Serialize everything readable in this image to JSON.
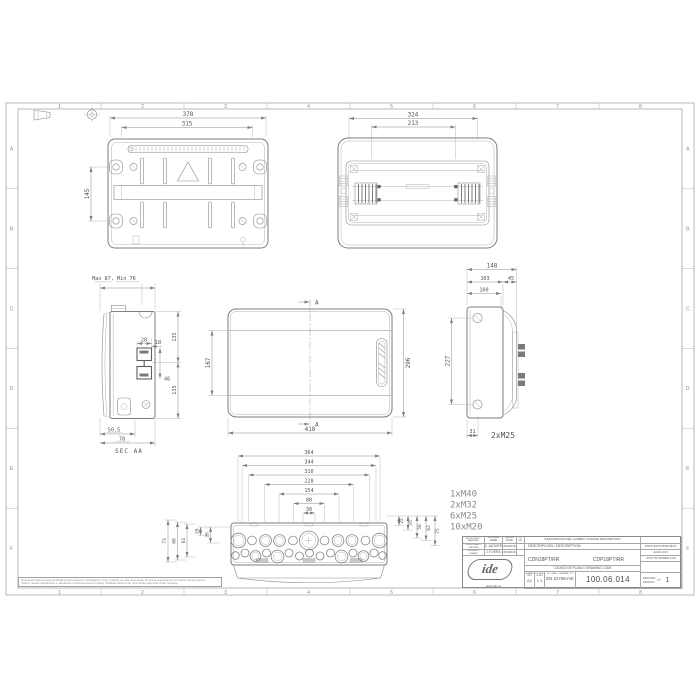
{
  "sheet": {
    "columns": [
      "1",
      "2",
      "3",
      "4",
      "5",
      "6",
      "7",
      "8"
    ],
    "rows": [
      "A",
      "B",
      "C",
      "D",
      "E",
      "F"
    ],
    "disclaimer_1": "Queda terminantemente prohibida la reproducción o divulgación, total o parcial, de este documento sin previa autorización por escrito de la empresa.",
    "disclaimer_2": "Total or partial reproduction or disclosure of this document is strictly forbidden without the prior written approval of the company."
  },
  "views": {
    "back": {
      "dim_378": "378",
      "dim_315": "315",
      "dim_145": "145"
    },
    "front_open": {
      "dim_324": "324",
      "dim_213": "213"
    },
    "section": {
      "max_min": "Max 87, Min 76",
      "dim_135_top": "135",
      "dim_28": "28",
      "dim_18": "18",
      "dim_46": "46",
      "dim_135_bottom": "135",
      "dim_50_5": "50.5",
      "dim_78": "78",
      "caption": "SEC AA"
    },
    "door": {
      "marker_top": "A",
      "marker_bottom": "A",
      "dim_167": "167",
      "dim_296": "296",
      "dim_418": "418"
    },
    "side": {
      "dim_148": "148",
      "dim_103": "103",
      "dim_45": "45",
      "dim_100": "100",
      "dim_227": "227",
      "dim_31": "31",
      "glands": "2xM25"
    },
    "bottom": {
      "h_dims": [
        "364",
        "344",
        "310",
        "228",
        "154",
        "80",
        "30"
      ],
      "left_dims": [
        "73",
        "68",
        "61",
        "20",
        "26"
      ],
      "right_dims": [
        "22",
        "35",
        "56",
        "62",
        "75"
      ],
      "legend": [
        "1xM40",
        "2xM32",
        "6xM25",
        "10xM20"
      ]
    }
  },
  "title_block": {
    "headers": {
      "amended": "MODIFICADO / AMENDED",
      "name": "NOMBRE NAME",
      "date": "FECHA DATE",
      "edi": "Nº EDI.",
      "change": "DESCRIPCION DEL CAMBIO. CHANGE DESCRIPTION",
      "checked": "COMPROBADO / CHECKED",
      "drawn": "DIBUJADO / DRAWN",
      "description": "DESCRIPCION / DESCRIPTION",
      "project": "PROYECTO/PROJECT",
      "ecology": "ECOLOGY",
      "replace": "SUSTITUYE/REPLACE",
      "drawing_code": "CODIGO DE PLANO / DRAWING CODE",
      "size_label": "TAMAÑO SIZE",
      "scale_label": "ESCALA SCALE",
      "tolerance_label": "TOL. GRAL. / GENERAL TOL.",
      "edition_line1": "EDICION/",
      "edition_line2": "EDITION",
      "number_sign": "Nº"
    },
    "values": {
      "checked_by": "C.JACINTE",
      "checked_date": "8/9/2016",
      "drawn_by": "J.F.VERA",
      "drawn_date": "8/9/2016",
      "code_1": "CDN18PT/RR",
      "code_2": "CDP18PTIRR",
      "size": "A2",
      "scale": "1:1",
      "tolerance": "EN 22768-mK",
      "drawing_code": "100.06.014",
      "edition": "1"
    },
    "logo": {
      "text": "ide",
      "url": "www.ide.es"
    }
  }
}
